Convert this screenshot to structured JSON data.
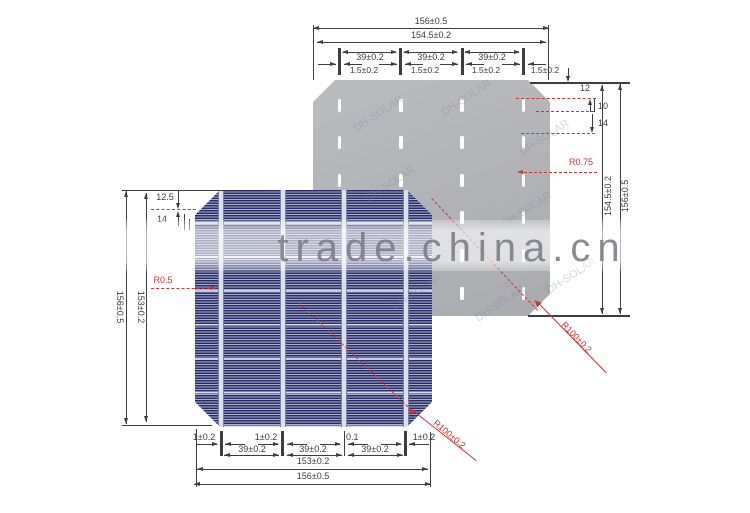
{
  "watermark": {
    "site_text": "trade.china.cn",
    "brand_text": "DH-SOLAR"
  },
  "colors": {
    "annotation_red": "#cc3433",
    "dimension_dark": "#3d3d3f",
    "cell_back_gray": "#b0b2b6",
    "cell_front_blue": "#272d63",
    "busbar_light": "#dce0ee"
  },
  "back_cell": {
    "busbar_columns": 4,
    "pads_per_column": 6,
    "dims": {
      "overall_width": "156±0.5",
      "active_width": "154.5±0.2",
      "busbar_pitch": "39±0.2",
      "busbar_width": "1.5±0.2",
      "pad_top_offset": "12",
      "pad_length": "10",
      "pad_gap": "14",
      "pad_corner_radius": "R0.75",
      "active_height": "154.5±0.2",
      "overall_height": "156±0.5",
      "corner_radius": "R100±0.2"
    }
  },
  "front_cell": {
    "busbars": 4,
    "dims": {
      "overall_height": "156±0.5",
      "active_height": "153±0.2",
      "edge_offset": "12.5",
      "pad_gap": "14",
      "busbar_corner_radius": "R0.5",
      "busbar_width": "1±0.2",
      "busbar_width_alt": "0.1",
      "busbar_pitch": "39±0.2",
      "active_width": "153±0.2",
      "overall_width": "156±0.5",
      "corner_radius": "R100±0.2"
    }
  }
}
